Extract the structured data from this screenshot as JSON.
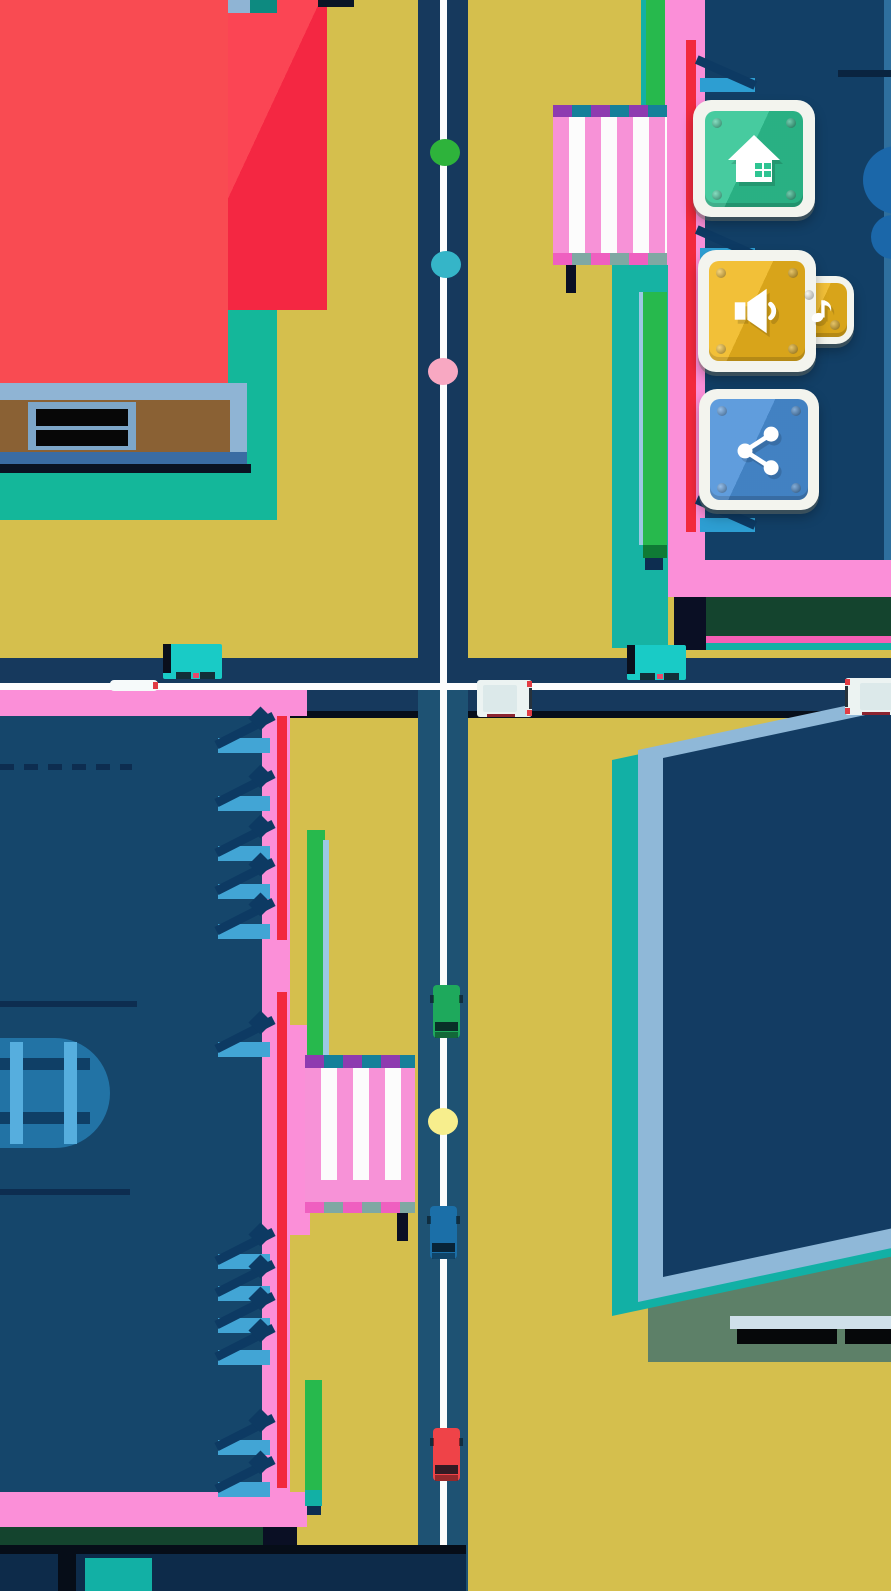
{
  "app": {
    "name": "top-down-traffic-game"
  },
  "hud": {
    "buttons": [
      {
        "id": "music",
        "icon": "music-note-icon",
        "color": "#f0b71d",
        "frame_color": "#f3f4ee"
      },
      {
        "id": "sound",
        "icon": "speaker-icon",
        "color": "#f0b71d",
        "frame_color": "#f3f4ee"
      },
      {
        "id": "home",
        "icon": "home-icon",
        "color": "#2ec492",
        "frame_color": "#f3f4ee"
      },
      {
        "id": "share",
        "icon": "share-icon",
        "color": "#4a90d8",
        "frame_color": "#f3f4ee"
      }
    ]
  },
  "scene": {
    "palette": {
      "ground": "#d5bf4d",
      "road_upper": "#16395d",
      "road_lower": "#1e5273",
      "lane_line": "#fcfcfc",
      "road_edge_black": "#070e1a",
      "building_pink_border": "#fb8fd8",
      "building_red_stripe": "#f2293d",
      "building_navy": "#15466b",
      "building_navy_dark": "#123f66",
      "building_roof_red": "#f94b52",
      "teal_base": "#14b79a",
      "teal_strip": "#12b0a5",
      "bright_green": "#27b94d",
      "forest_green": "#14442e",
      "sage_entrance": "#5d8068",
      "steel_blue": "#8fb4d4",
      "brown": "#8a6134",
      "crosswalk_pink": "#f792d7",
      "crosswalk_white": "#fcfcfc",
      "crosswalk_cap_purple": "#8e3bb0",
      "crosswalk_cap_teal": "#15809a"
    },
    "pedestrians": [
      {
        "color": "#2eb33b",
        "x": 430,
        "y": 139
      },
      {
        "color": "#35b5c8",
        "x": 431,
        "y": 251
      },
      {
        "color": "#f8a8c2",
        "x": 428,
        "y": 358
      },
      {
        "color": "#f7ee8d",
        "x": 428,
        "y": 1108
      }
    ],
    "vehicles": [
      {
        "type": "bus",
        "color": "#19cbc6",
        "x": 163,
        "y": 644,
        "heading": "right"
      },
      {
        "type": "bus",
        "color": "#19cbc6",
        "x": 627,
        "y": 645,
        "heading": "right"
      },
      {
        "type": "van",
        "color": "#ecf3f2",
        "x": 477,
        "y": 680,
        "heading": "right"
      },
      {
        "type": "van",
        "color": "#ecf3f2",
        "x": 845,
        "y": 678,
        "heading": "left",
        "flip": true
      },
      {
        "type": "mini",
        "color": "#f6fafa",
        "x": 110,
        "y": 680,
        "heading": "right"
      },
      {
        "type": "car",
        "color": "#1ea95c",
        "x": 433,
        "y": 985,
        "heading": "down"
      },
      {
        "type": "car",
        "color": "#1b6fa8",
        "x": 430,
        "y": 1206,
        "heading": "down"
      },
      {
        "type": "car",
        "color": "#ef4348",
        "x": 433,
        "y": 1428,
        "heading": "down"
      }
    ],
    "escalators_left": [
      712,
      770,
      820,
      858,
      898,
      1016,
      1228,
      1260,
      1292,
      1324,
      1414,
      1456
    ],
    "escalators_right": [
      58,
      228,
      498
    ]
  }
}
